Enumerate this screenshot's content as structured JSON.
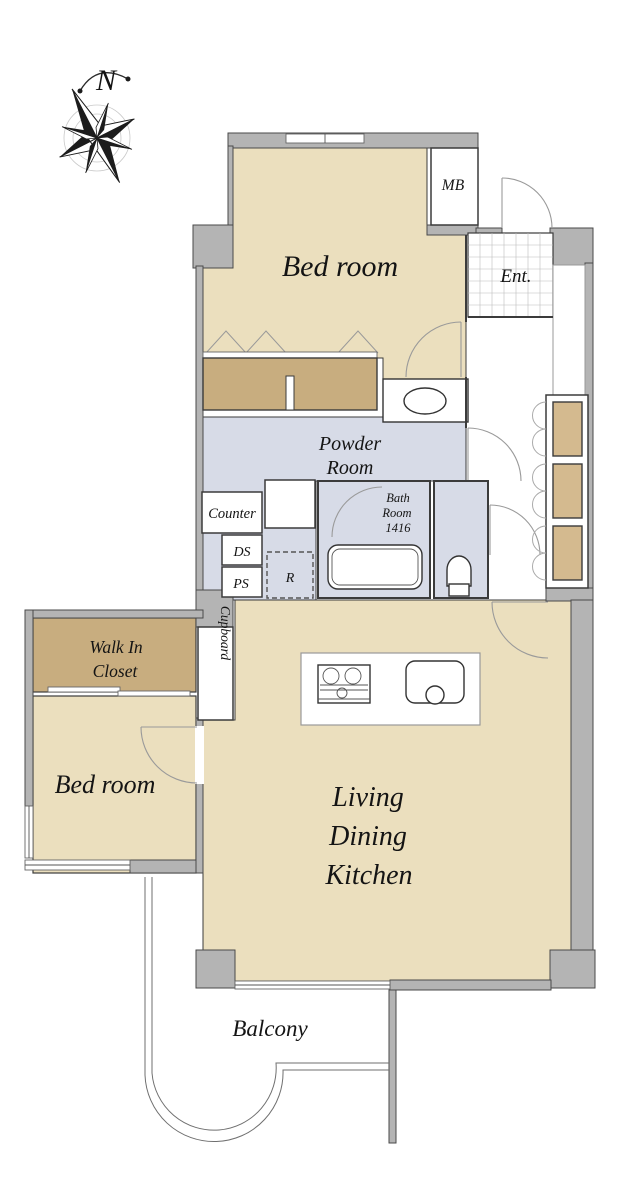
{
  "colors": {
    "room_beige": "#EBDFBE",
    "closet_tan": "#C8AD7F",
    "storage_tan": "#D4BA8F",
    "wet_blue": "#D7DBE7",
    "wall_gray": "#B4B4B4"
  },
  "compass": {
    "label": "N"
  },
  "labels": {
    "bedroom_top": "Bed room",
    "mb": "MB",
    "entrance": "Ent.",
    "powder_line1": "Powder",
    "powder_line2": "Room",
    "counter": "Counter",
    "bath_line1": "Bath",
    "bath_line2": "Room",
    "bath_line3": "1416",
    "ds": "DS",
    "ps": "PS",
    "refrigerator": "R",
    "walk_in_line1": "Walk In",
    "walk_in_line2": "Closet",
    "cupboard": "Cupboard",
    "bedroom_left": "Bed room",
    "ldk_line1": "Living",
    "ldk_line2": "Dining",
    "ldk_line3": "Kitchen",
    "balcony": "Balcony"
  }
}
